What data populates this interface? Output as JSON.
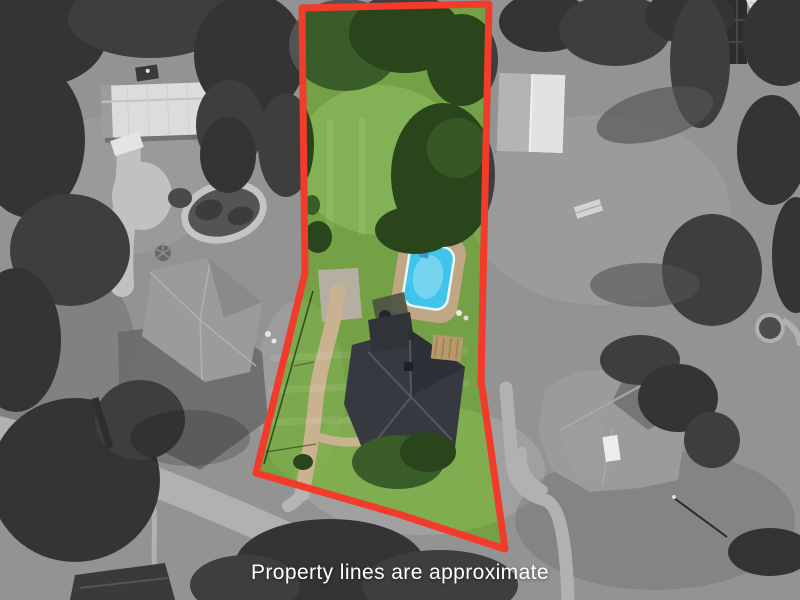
{
  "caption": {
    "text": "Property lines are approximate",
    "color": "#ffffff"
  },
  "property": {
    "polygon_points": "302,8 489,4 481,380 505,549 398,514 256,473 305,273",
    "line_color": "#f23b2b",
    "line_width": 7
  },
  "scene": {
    "colors": {
      "grass": "#74a046",
      "grass_light": "#85b256",
      "tree": "#2a451c",
      "tree_dark": "#223a15",
      "tree_light": "#3a5c28",
      "road": "#b6b0a5",
      "driveway_tan": "#c9b290",
      "concrete": "#b5aea1",
      "pool_water": "#41c4e9",
      "pool_water_light": "#7fd8f2",
      "pool_deck": "#bfa786",
      "roof_charcoal": "#363a40",
      "roof_gray": "#9b9b99",
      "barn_white": "#dcdcda"
    }
  }
}
